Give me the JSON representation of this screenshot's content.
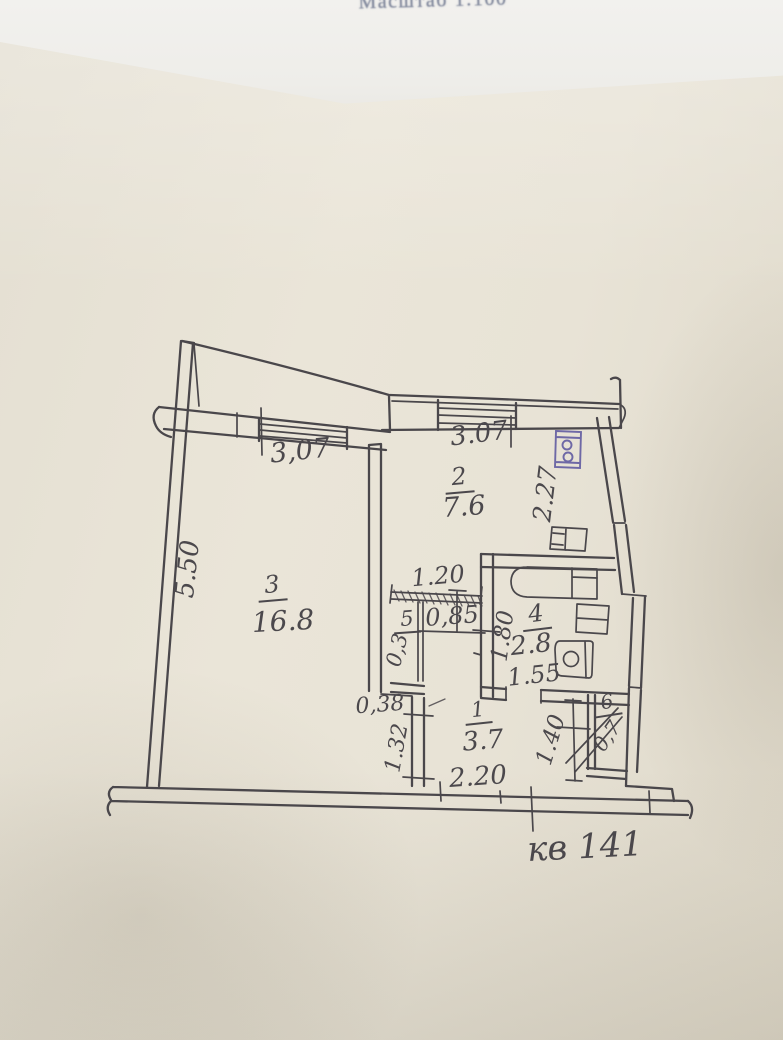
{
  "document": {
    "scale_note": "Масштаб 1:100",
    "apartment_label": "кв 141"
  },
  "floor_plan": {
    "rooms": {
      "r1": {
        "number": "1",
        "area": "3.7"
      },
      "r2": {
        "number": "2",
        "area": "7.6"
      },
      "r3": {
        "number": "3",
        "area": "16.8"
      },
      "r4": {
        "number": "4",
        "area": "2.8"
      },
      "r5": {
        "number": "5",
        "area": "0,3"
      },
      "r6": {
        "number": "6",
        "area": "0,7"
      }
    },
    "dimensions": {
      "d307_left": "3,07",
      "d307_top": "3.07",
      "d550": "5.50",
      "d227": "2.27",
      "d120": "1.20",
      "d085": "0,85",
      "d180": "1.80",
      "d155": "1.55",
      "d038": "0,38",
      "d132": "1.32",
      "d220": "2.20",
      "d140": "1.40"
    },
    "fixtures": [
      "bathtub",
      "wash-basin",
      "toilet",
      "kitchen-sink",
      "stove"
    ],
    "colors": {
      "ink": "#4a474b",
      "stove_ink": "#6e68a6",
      "paper": "#e8e3d6",
      "under_sheet": "#f2f1ee"
    }
  }
}
